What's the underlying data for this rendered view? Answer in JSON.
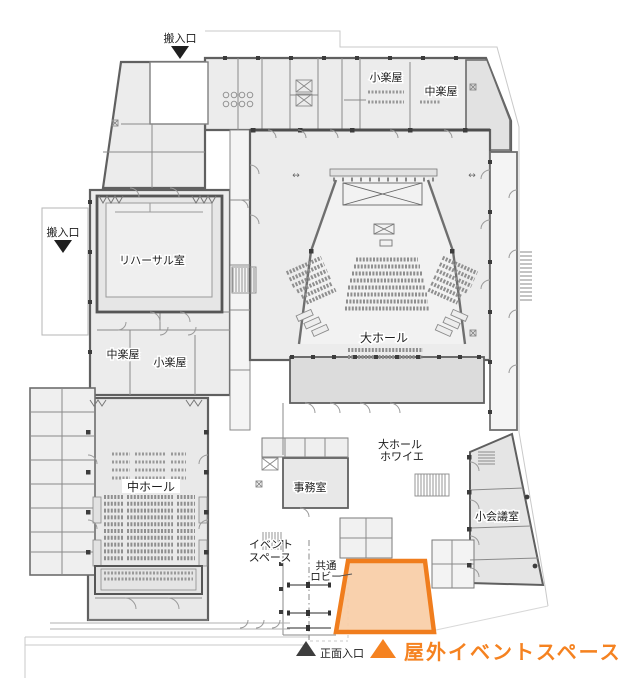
{
  "plan": {
    "labels": {
      "loading_entrance_top": "搬入口",
      "loading_entrance_left": "搬入口",
      "rehearsal_room": "リハーサル室",
      "small_dressing_room_top": "小楽屋",
      "medium_dressing_room_top": "中楽屋",
      "medium_dressing_room_mid": "中楽屋",
      "small_dressing_room_mid": "小楽屋",
      "large_hall": "大ホール",
      "medium_hall": "中ホール",
      "large_hall_foyer_line1": "大ホール",
      "large_hall_foyer_line2": "ホワイエ",
      "office": "事務室",
      "small_meeting_rooms": "小会議室",
      "event_space_line1": "イベント",
      "event_space_line2": "スペース",
      "common_lobby_line1": "共通",
      "common_lobby_line2": "ロビー",
      "main_entrance": "正面入口"
    },
    "legend": {
      "marker": "▲",
      "label": "屋外イベントスペース",
      "color": "#f58220"
    },
    "highlight": {
      "name": "屋外イベントスペース",
      "fill": "#f9cda6",
      "stroke": "#f07d1d"
    },
    "colors": {
      "walls": "#606060",
      "room_fill": "#ececec",
      "foyer_fill": "#dcdcdc",
      "site_line": "#c9c9c9"
    }
  }
}
